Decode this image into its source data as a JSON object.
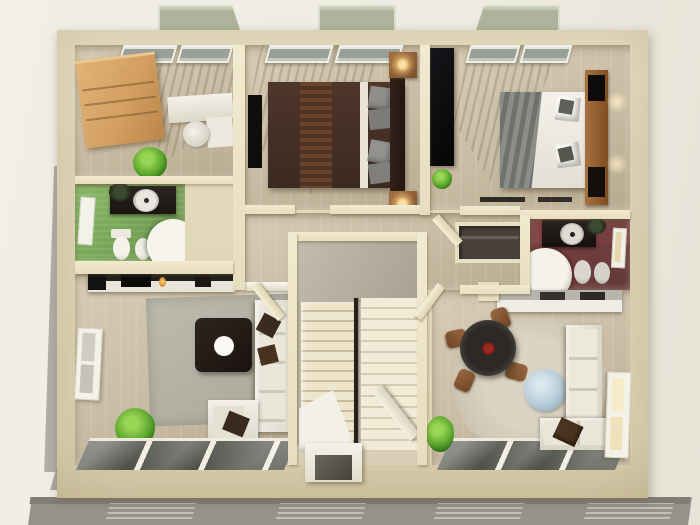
{
  "meta": {
    "title": "3D cutaway floor plan render of an apartment upper storey, viewed top-down",
    "render_style": "architectural 3D dollhouse visualization",
    "visible_text": "none"
  },
  "palette": {
    "background": "#efece3",
    "exterior_wall": "#e3d9bc",
    "interior_wall": "#ece3c8",
    "wood_floor": "#cbbfa8",
    "green_bathroom": "#7aa95a",
    "red_bathroom": "#7a4044",
    "wardrobe_wood": "#d3a061",
    "dark_wood": "#8a5c39",
    "bed_dark_brown": "#3c2a20",
    "sofa_white": "#f0ede4",
    "rug_gray": "#b4b3a6",
    "rug_beige": "#d4ccbb",
    "glass_table_blue": "#b6ccd8",
    "window_glass_dark": "#565a52",
    "skylight_glass": "#aeb49c",
    "stair_concrete": "#b6b0a3",
    "stair_steps": "#ece3cc",
    "shadow_gray": "#a5a29b"
  },
  "exterior": {
    "roof_skylights": 3,
    "lower_storey_visible_below": true,
    "drop_shadow_side": "left",
    "south_wall": "full-width dark glazing panels with pale mullions"
  },
  "rooms": [
    {
      "id": "office-bedroom",
      "position": "top-left",
      "floor": "light wood",
      "furniture": [
        "wood wardrobe",
        "white desk",
        "white swivel chair",
        "potted plant",
        "venetian-blind windows"
      ]
    },
    {
      "id": "green-bathroom",
      "position": "mid-left",
      "floor": "green tile",
      "furniture": [
        "dark vanity with round sink",
        "wall mirror",
        "toilet",
        "bidet",
        "round corner shower"
      ]
    },
    {
      "id": "living-room",
      "position": "bottom-left",
      "floor": "light wood",
      "furniture": [
        "tv console with candle",
        "flat tv",
        "side table with black vase",
        "gray rug",
        "dark coffee table with white plate",
        "white sofa with brown pillows",
        "white armchair",
        "potted plant",
        "side window",
        "glazed south wall"
      ]
    },
    {
      "id": "bedroom-middle",
      "position": "top-center",
      "floor": "light wood",
      "furniture": [
        "dark brown double bed with throw",
        "gray pillows",
        "two wood nightstands with lamps",
        "wall tv",
        "venetian-blind windows"
      ]
    },
    {
      "id": "bedroom-right",
      "position": "top-right",
      "floor": "light wood",
      "furniture": [
        "black wardrobe",
        "white double bed with gray blanket",
        "wood shelf headboard with cubbies",
        "wall sconces",
        "potted plant",
        "venetian-blind windows"
      ]
    },
    {
      "id": "red-bathroom",
      "position": "mid-right",
      "floor": "maroon",
      "furniture": [
        "dark vanity with round sink",
        "round corner shower",
        "toilet",
        "bidet",
        "wall mirror"
      ]
    },
    {
      "id": "hallway",
      "position": "center",
      "floor": "light wood",
      "furniture": [
        "white banister",
        "built-in closet",
        "open doors"
      ]
    },
    {
      "id": "stairwell",
      "position": "center",
      "floor": "concrete landing",
      "furniture": [
        "two stair flights",
        "dark handrail",
        "under-stair wall",
        "entry closet",
        "open front door"
      ]
    },
    {
      "id": "dining-living",
      "position": "bottom-right",
      "floor": "light wood",
      "furniture": [
        "kitchen counter with appliances",
        "round beige rug",
        "round black dining table with red centerpiece",
        "four brown chairs",
        "round blue glass table",
        "white sectional sofa with brown pillow",
        "potted plant",
        "side window",
        "glazed south wall"
      ]
    }
  ]
}
